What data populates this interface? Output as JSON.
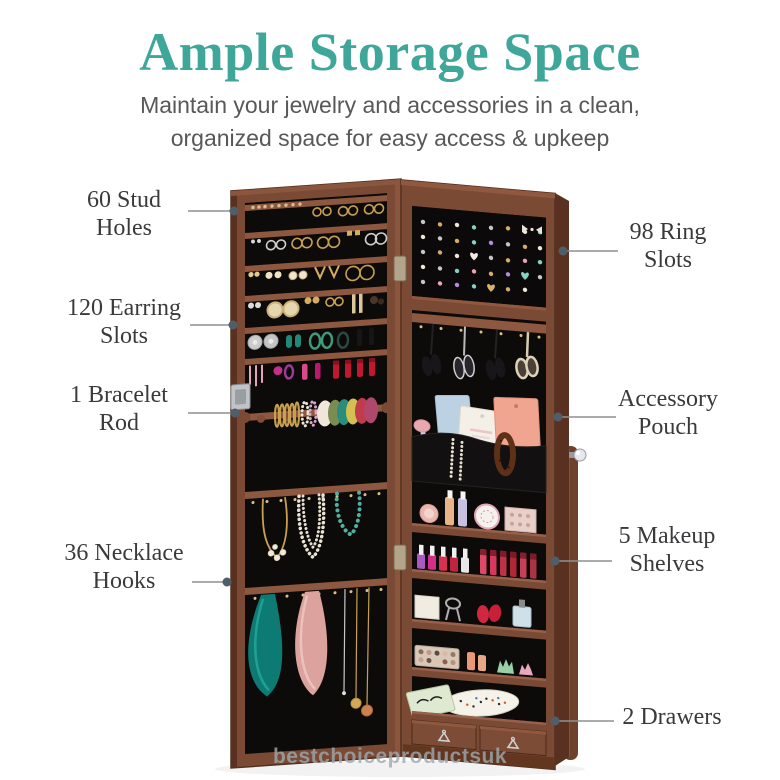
{
  "header": {
    "title": "Ample Storage Space",
    "subtitle_line1": "Maintain your jewelry and accessories in a clean,",
    "subtitle_line2": "organized space for easy access & upkeep"
  },
  "callouts": {
    "left": [
      {
        "label": "60 Stud Holes"
      },
      {
        "label": "120 Earring Slots"
      },
      {
        "label": "1 Bracelet Rod"
      },
      {
        "label": "36 Necklace Hooks"
      }
    ],
    "right": [
      {
        "label": "98 Ring Slots"
      },
      {
        "label": "Accessory Pouch"
      },
      {
        "label": "5 Makeup Shelves"
      },
      {
        "label": "2 Drawers"
      }
    ]
  },
  "watermark": "bestchoiceproductsuk",
  "illustration": {
    "subject": "Open wall jewelry armoire cabinet",
    "left_door_features": [
      "stud hole bars with earrings",
      "earring slot bars",
      "bracelet rod with bangles and scrunchies",
      "necklace hooks with necklaces and scarves",
      "lock"
    ],
    "right_cabinet_features": [
      "ring slot panel with rings",
      "sunglasses hooks",
      "accessory pouch with cards and pearls",
      "five makeup shelves with cosmetics",
      "two drawers with metal pulls",
      "crystal door knob"
    ]
  },
  "colors": {
    "accent_teal": "#3fa79a",
    "subtitle_gray": "#57585a",
    "label_gray": "#3a3a3c",
    "callout_line": "#8f8f8f",
    "callout_dot": "#4f5f6a",
    "wood_dark": "#5a3121",
    "wood_mid": "#7a4a35",
    "wood_bar": "#8d583f",
    "interior_black": "#0d0b0a",
    "watermark_gray": "#9fa9b0"
  }
}
